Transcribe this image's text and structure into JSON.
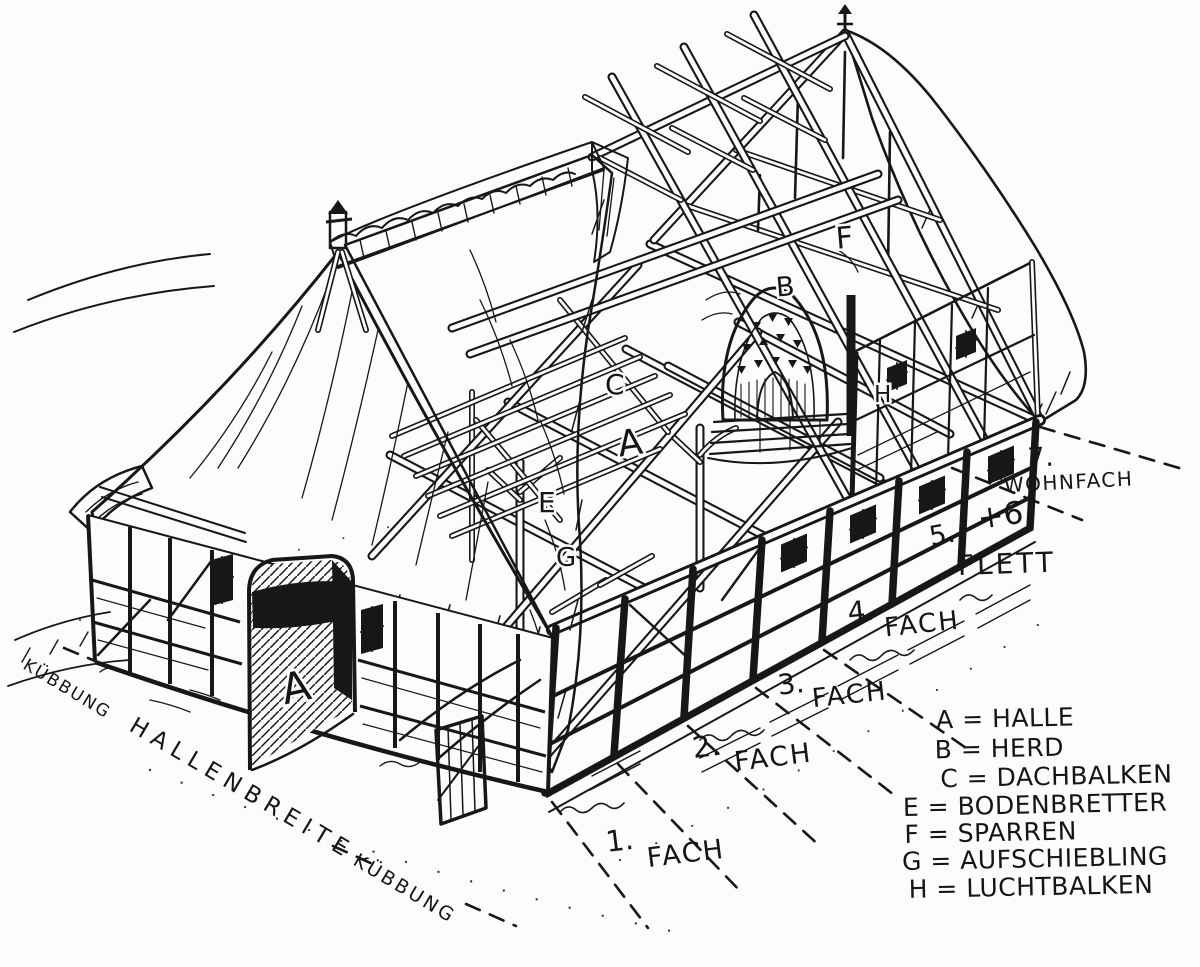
{
  "figure": {
    "kind": "hand-drawn cutaway construction drawing",
    "subject": "Niederdeutsches Hallenhaus (Low German hall house) timber frame",
    "ink_color": "#181716",
    "paper_color": "#fcfcfa"
  },
  "bays": [
    {
      "num": "1.",
      "word": "FACH"
    },
    {
      "num": "2.",
      "word": "FACH"
    },
    {
      "num": "3.",
      "word": "FACH"
    },
    {
      "num": "4.",
      "word": "FACH"
    },
    {
      "num": "5.",
      "num2": "+6",
      "word": "FLETT"
    },
    {
      "num": "7.",
      "word": "WOHNFACH"
    }
  ],
  "ground_labels": {
    "kuebbung_left": "KÜBBUNG",
    "hallenbreite": "HALLENBREITE",
    "kuebbung_right": "KÜBBUNG"
  },
  "marks": {
    "halle_door": "A",
    "halle": "A",
    "herd": "B",
    "dachbalken": "C",
    "bodenbretter": "E",
    "sparren": "F",
    "aufschiebling": "G",
    "luchtbalken": "H"
  },
  "legend": {
    "items": [
      {
        "label": "A = HALLE"
      },
      {
        "label": "B = HERD"
      },
      {
        "label": "C = DACHBALKEN"
      },
      {
        "label": "E = BODENBRETTER"
      },
      {
        "label": "F = SPARREN"
      },
      {
        "label": "G = AUFSCHIEBLING"
      },
      {
        "label": "H = LUCHTBALKEN"
      }
    ]
  }
}
